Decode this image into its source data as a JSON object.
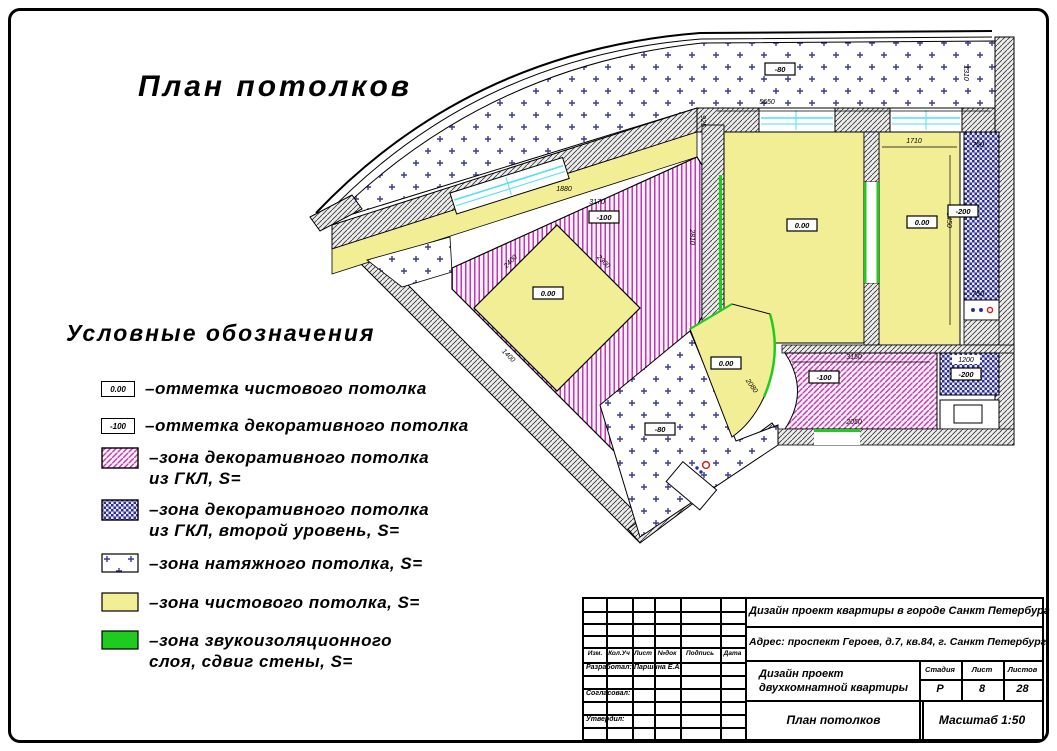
{
  "page": {
    "main_title": "План потолков",
    "legend_title": "Условные обозначения"
  },
  "legend": {
    "items": [
      {
        "mark": "0.00",
        "line1": "–отметка чистового потолка",
        "line2": ""
      },
      {
        "mark": "-100",
        "line1": "–отметка декоративного потолка",
        "line2": ""
      },
      {
        "line1": "–зона декоративного потолка",
        "line2": "из ГКЛ, S="
      },
      {
        "line1": "–зона декоративного потолка",
        "line2": "из ГКЛ, второй уровень, S="
      },
      {
        "line1": "–зона натяжного потолка, S=",
        "line2": ""
      },
      {
        "line1": "–зона чистового потолка, S=",
        "line2": ""
      },
      {
        "line1": "–зона звукоизоляционного",
        "line2": "слоя, сдвиг стены, S="
      }
    ]
  },
  "plan": {
    "elevations": {
      "balcony_top": "-80",
      "bedroom_left": "0.00",
      "bedroom_right": "0.00",
      "strip_right": "-200",
      "central_zone": "-100",
      "island": "0.00",
      "arc_room": "0.00",
      "hall": "-80",
      "living_right": "-100",
      "second_level_right": "-200"
    },
    "dimensions": [
      "5650",
      "1310",
      "925",
      "1710",
      "750",
      "3450",
      "750",
      "1880",
      "3170",
      "2810",
      "2400",
      "2300",
      "1400",
      "2080",
      "3150",
      "1200",
      "2050"
    ]
  },
  "colors": {
    "decor_magenta": "#c03ab4",
    "second_level_navy": "#2e2e96",
    "finished_yellow": "#f2ee96",
    "soundproof_green": "#1ecb1e",
    "window_cyan": "#55dfef"
  },
  "title_block": {
    "project_line": "Дизайн проект квартиры в городе Санкт Петербург",
    "address_line": "Адрес: проспект Героев, д.7, кв.84, г. Санкт Петербург",
    "col_izm": "Изм.",
    "col_koluch": "Кол.Уч",
    "col_list": "Лист",
    "col_ndok": "№док",
    "col_podpis": "Подпись",
    "col_data": "Дата",
    "developed_label": "Разработал:",
    "developer_name": "Паршина Е.А.",
    "agreed_label": "Согласовал:",
    "approved_label": "Утвердил:",
    "doc_title_line1": "Дизайн проект",
    "doc_title_line2": "двухкомнатной квартиры",
    "stage_label": "Стадия",
    "sheet_label": "Лист",
    "sheets_label": "Листов",
    "stage_value": "Р",
    "sheet_value": "8",
    "sheets_value": "28",
    "drawing_name": "План потолков",
    "scale_text": "Масштаб 1:50"
  }
}
